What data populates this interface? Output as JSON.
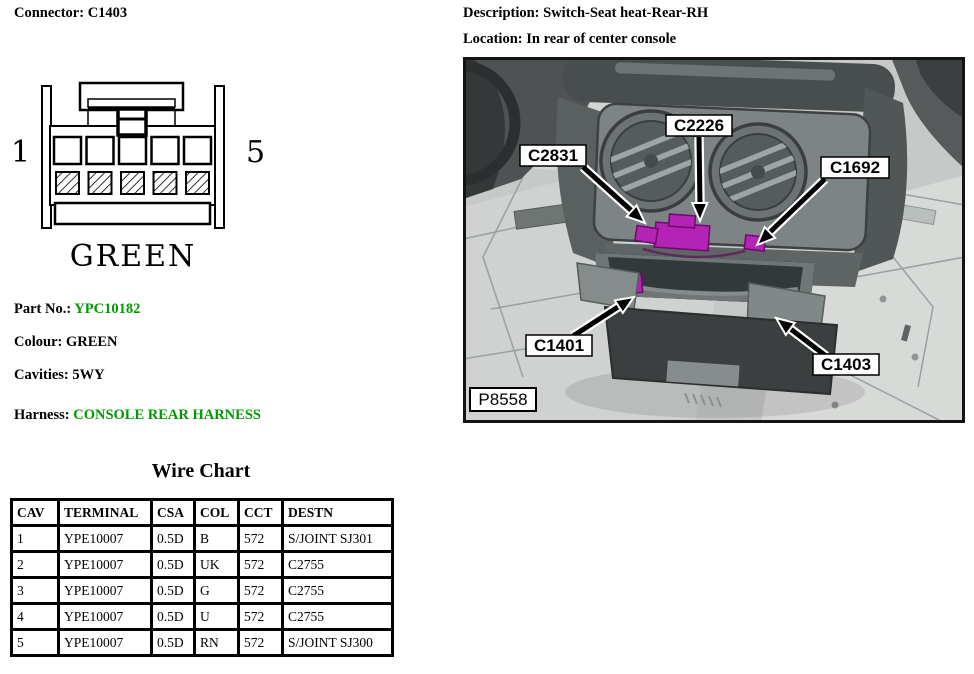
{
  "connector_panel": {
    "title": "Connector: C1403",
    "diagram": {
      "pin_first": "1",
      "pin_last": "5",
      "colour_caption": "GREEN"
    },
    "part_no_label": "Part No.:",
    "part_no_value": "YPC10182",
    "colour_line": "Colour: GREEN",
    "cavities_line": "Cavities: 5WY",
    "harness_label": "Harness:",
    "harness_value": "CONSOLE REAR HARNESS",
    "value_color": "#009a00"
  },
  "location_panel": {
    "description_line": "Description: Switch-Seat heat-Rear-RH",
    "location_line": "Location: In rear of center console",
    "photo": {
      "labels": {
        "left_vent_connector": "C2831",
        "center_connector": "C2226",
        "right_vent_connector": "C1692",
        "lower_left_connector": "C1401",
        "lower_right_connector": "C1403",
        "photo_id": "P8558"
      },
      "highlight_color": "#b424b4"
    }
  },
  "wire_chart": {
    "title": "Wire Chart",
    "headers": [
      "CAV",
      "TERMINAL",
      "CSA",
      "COL",
      "CCT",
      "DESTN"
    ],
    "rows": [
      {
        "cav": "1",
        "terminal": "YPE10007",
        "csa": "0.5D",
        "col": "B",
        "cct": "572",
        "destn": "S/JOINT SJ301"
      },
      {
        "cav": "2",
        "terminal": "YPE10007",
        "csa": "0.5D",
        "col": "UK",
        "cct": "572",
        "destn": "C2755"
      },
      {
        "cav": "3",
        "terminal": "YPE10007",
        "csa": "0.5D",
        "col": "G",
        "cct": "572",
        "destn": "C2755"
      },
      {
        "cav": "4",
        "terminal": "YPE10007",
        "csa": "0.5D",
        "col": "U",
        "cct": "572",
        "destn": "C2755"
      },
      {
        "cav": "5",
        "terminal": "YPE10007",
        "csa": "0.5D",
        "col": "RN",
        "cct": "572",
        "destn": "S/JOINT SJ300"
      }
    ]
  }
}
